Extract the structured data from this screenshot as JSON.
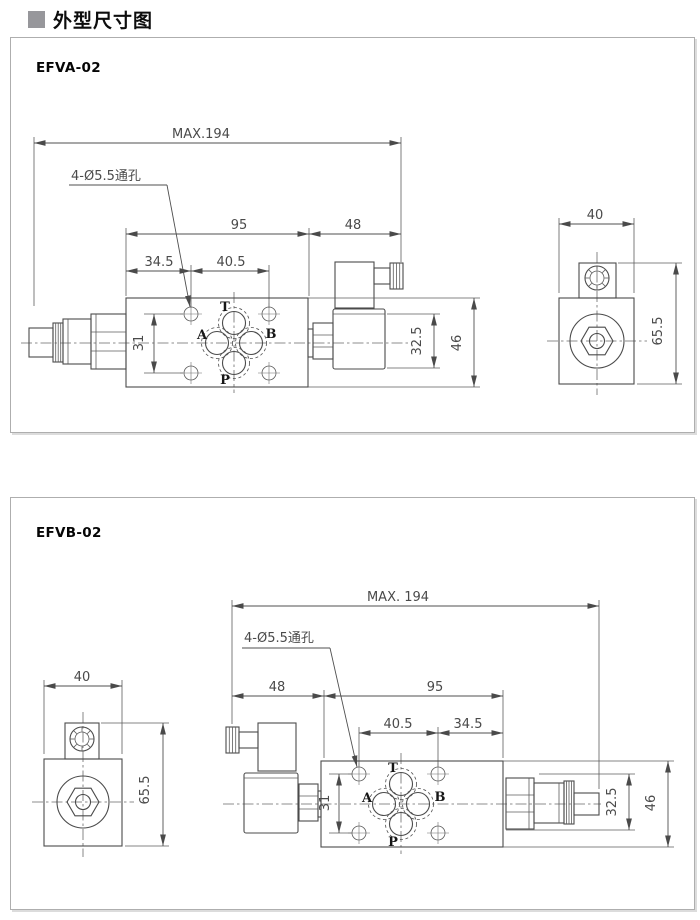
{
  "header": {
    "title": "外型尺寸图"
  },
  "panel_a": {
    "model": "EFVA-02",
    "holes_label": "4-Ø5.5通孔",
    "dims": {
      "overall": "MAX.194",
      "d95": "95",
      "d48": "48",
      "d345": "34.5",
      "d405": "40.5",
      "d31": "31",
      "d325": "32.5",
      "d46": "46",
      "d40": "40",
      "d655": "65.5"
    },
    "ports": {
      "t": "T",
      "a": "A",
      "b": "B",
      "p": "P"
    }
  },
  "panel_b": {
    "model": "EFVB-02",
    "holes_label": "4-Ø5.5通孔",
    "dims": {
      "overall": "MAX. 194",
      "d48": "48",
      "d95": "95",
      "d405": "40.5",
      "d345": "34.5",
      "d31": "31",
      "d325": "32.5",
      "d46": "46",
      "d40": "40",
      "d655": "65.5"
    },
    "ports": {
      "t": "T",
      "a": "A",
      "b": "B",
      "p": "P"
    }
  },
  "colors": {
    "line": "#4b4b4b",
    "dim_text": "#4a4a4a",
    "panel_border": "#aeaeae",
    "title_square": "#97979b"
  }
}
